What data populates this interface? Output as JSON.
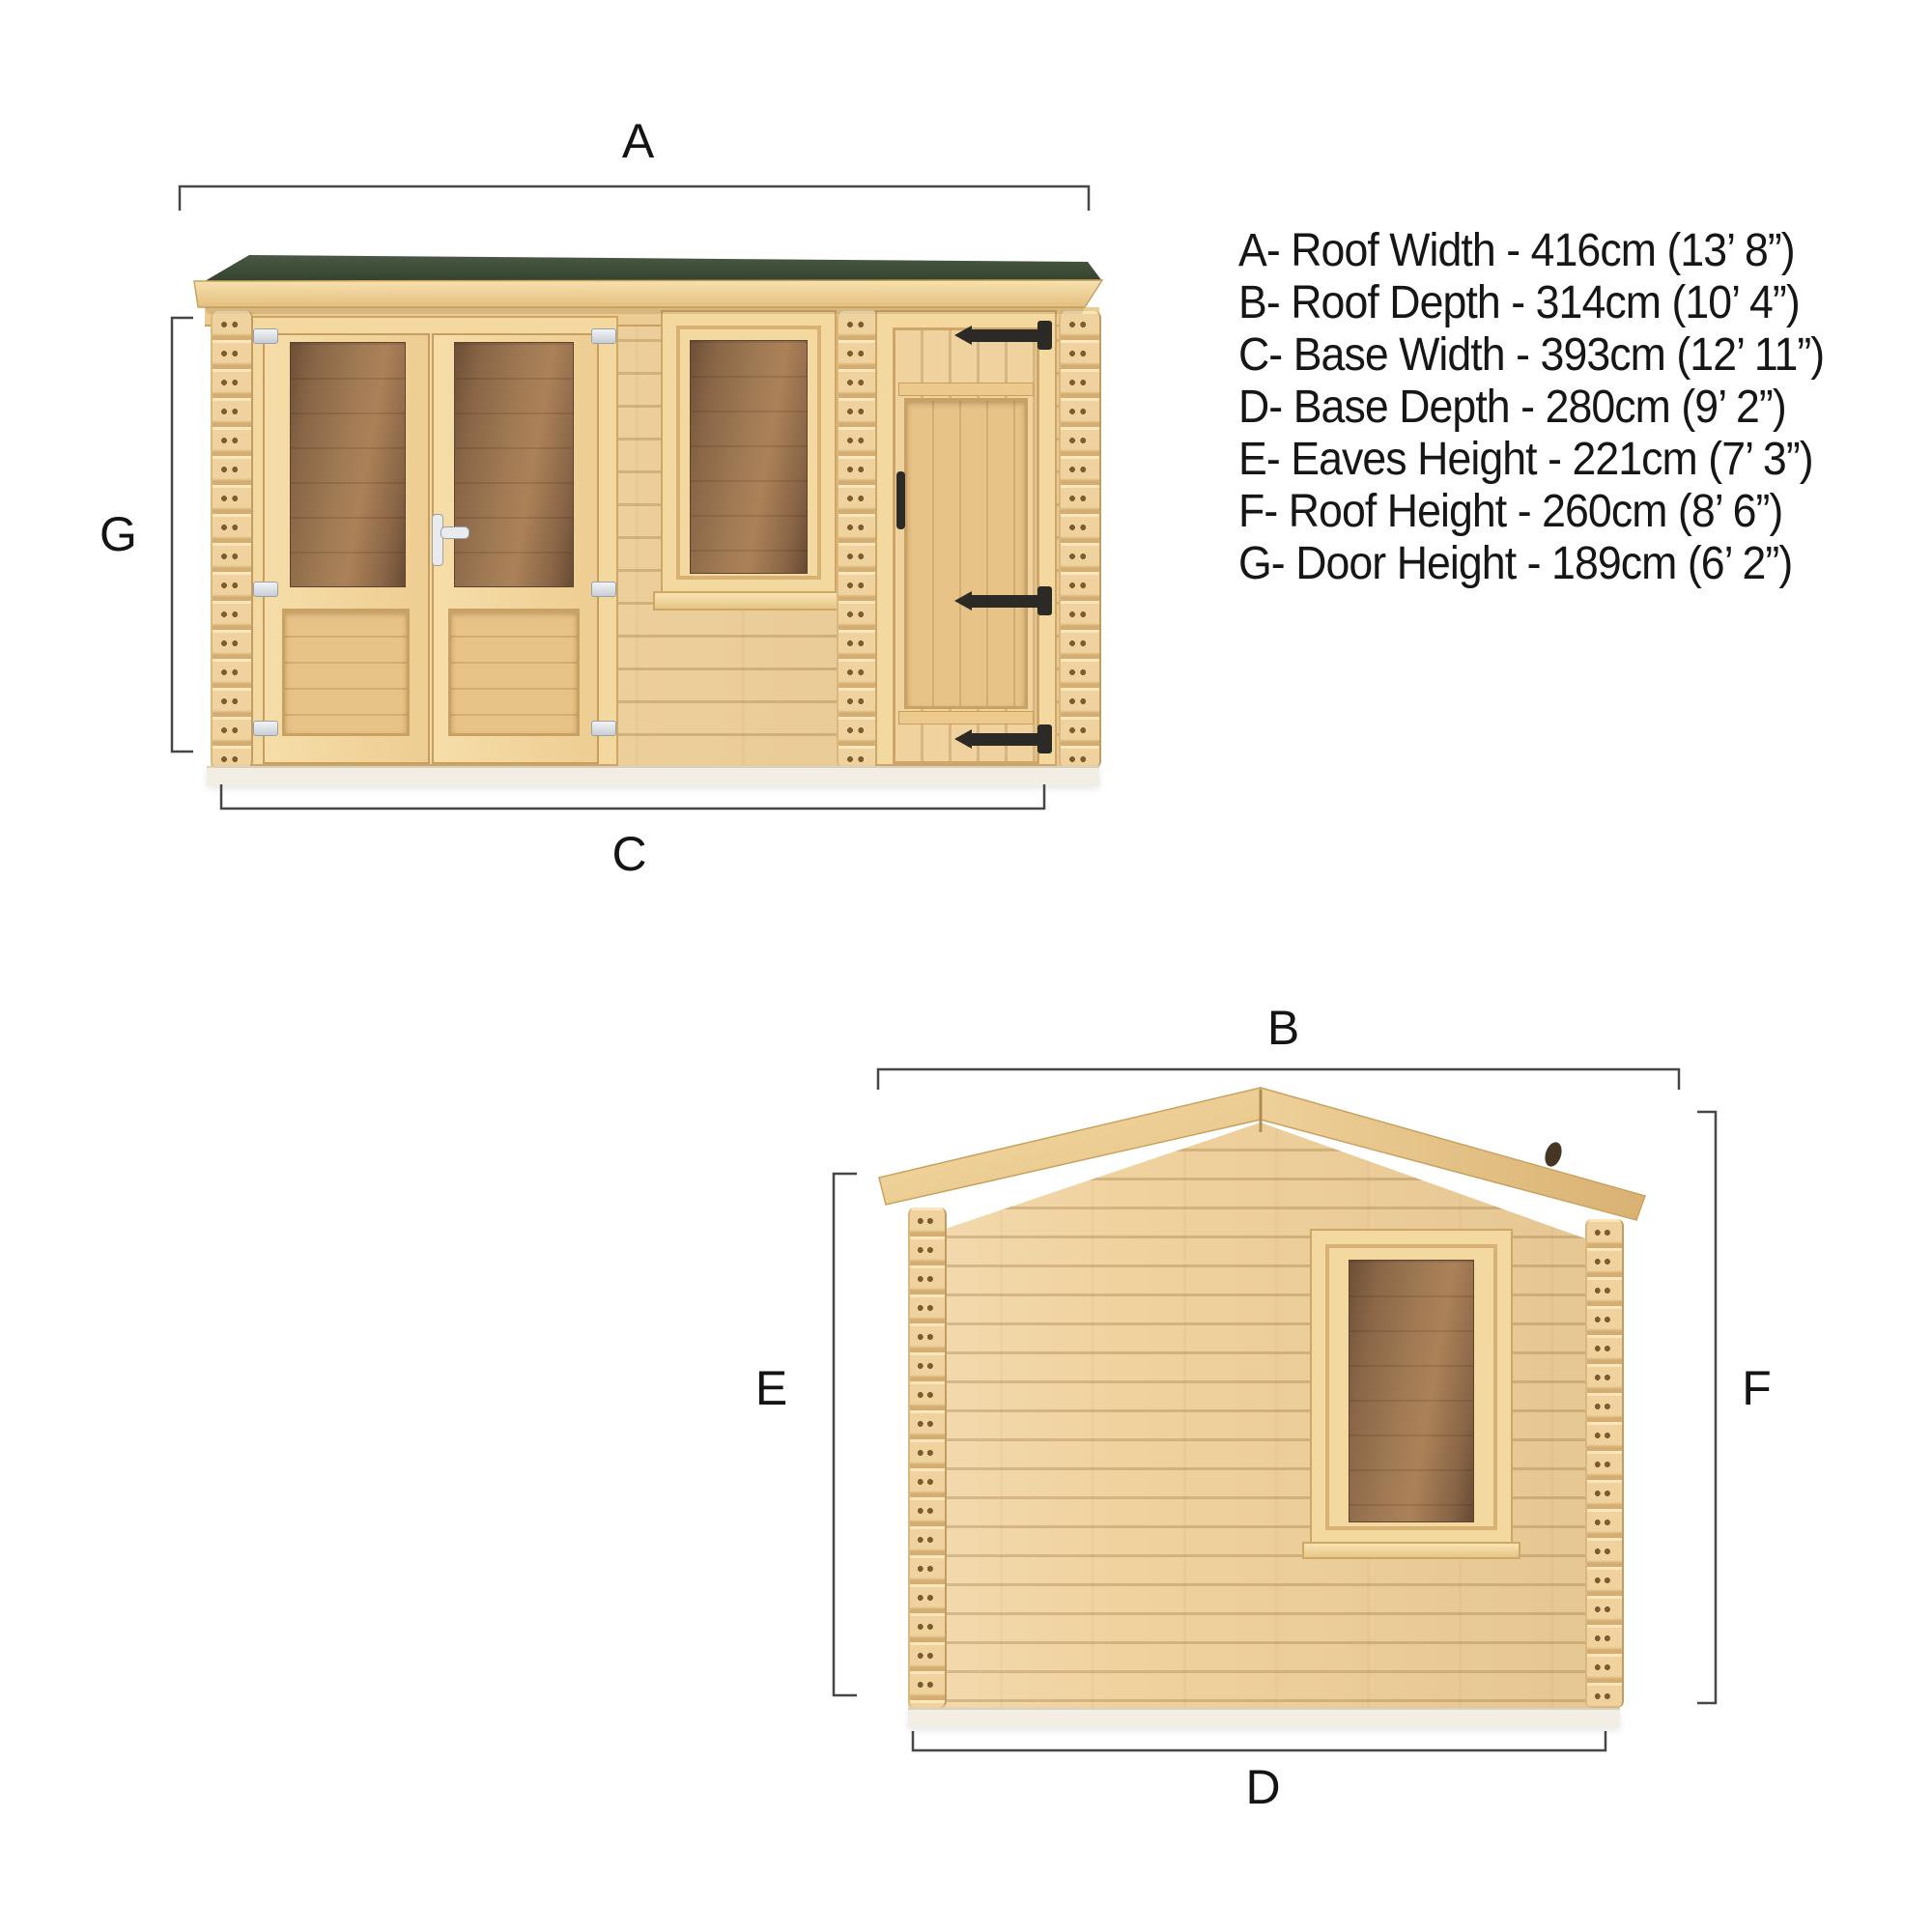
{
  "legend": {
    "lines": [
      "A- Roof Width - 416cm (13’ 8”)",
      "B- Roof Depth - 314cm (10’ 4”)",
      "C- Base Width - 393cm (12’ 11”)",
      "D- Base Depth - 280cm (9’ 2”)",
      "E- Eaves Height - 221cm (7’ 3”)",
      "F- Roof Height - 260cm (8’ 6”)",
      "G- Door Height - 189cm (6’ 2”)"
    ]
  },
  "labels": {
    "A": "A",
    "B": "B",
    "C": "C",
    "D": "D",
    "E": "E",
    "F": "F",
    "G": "G"
  },
  "dimensions": {
    "roof_width": {
      "key": "A",
      "name": "Roof Width",
      "cm": 416,
      "imperial": "13’ 8”"
    },
    "roof_depth": {
      "key": "B",
      "name": "Roof Depth",
      "cm": 314,
      "imperial": "10’ 4”"
    },
    "base_width": {
      "key": "C",
      "name": "Base Width",
      "cm": 393,
      "imperial": "12’ 11”"
    },
    "base_depth": {
      "key": "D",
      "name": "Base Depth",
      "cm": 280,
      "imperial": "9’ 2”"
    },
    "eaves_height": {
      "key": "E",
      "name": "Eaves Height",
      "cm": 221,
      "imperial": "7’ 3”"
    },
    "roof_height": {
      "key": "F",
      "name": "Roof Height",
      "cm": 260,
      "imperial": "8’ 6”"
    },
    "door_height": {
      "key": "G",
      "name": "Door Height",
      "cm": 189,
      "imperial": "6’ 2”"
    }
  },
  "views": {
    "front": "front-elevation",
    "side": "side-elevation"
  },
  "colors": {
    "roof_green_top": "#4a5943",
    "roof_green_bottom": "#35432e",
    "wood_light": "#f0d29e",
    "wood_hi": "#f9e6bb",
    "wood_mid": "#e7c388",
    "wood_shadow": "#d3ad72",
    "wood_frame": "#f3d89f",
    "line": "#474747",
    "label": "#141414",
    "hinge": "#2c2a27",
    "handle": "#e9ebef",
    "base_strip": "#f2eee4"
  }
}
